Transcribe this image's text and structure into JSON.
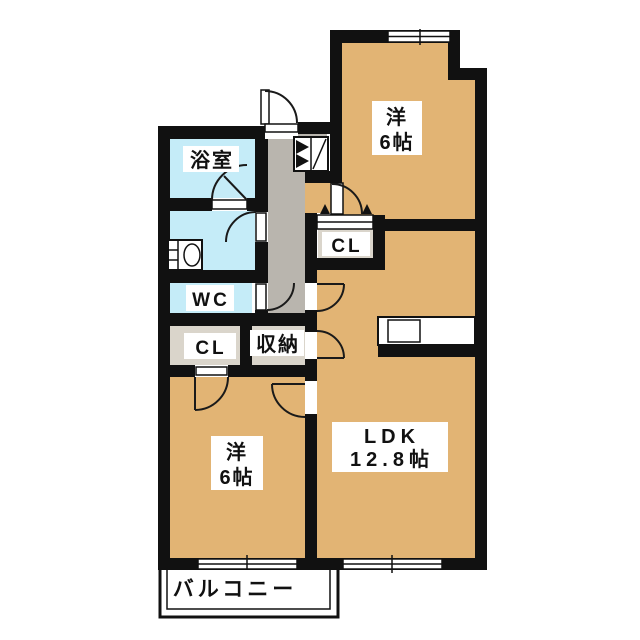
{
  "floorplan": {
    "labels": {
      "bathroom": "浴室",
      "toilet": "WC",
      "hall_closet": "CL",
      "storage": "収納",
      "bedroom_top_closet": "CL",
      "bedroom_top_name": "洋",
      "bedroom_top_size": "6帖",
      "bedroom_bottom_name": "洋",
      "bedroom_bottom_size": "6帖",
      "ldk_name": "LDK",
      "ldk_size": "12.8帖",
      "balcony": "バルコニー"
    },
    "colors": {
      "room": "#e2b474",
      "wet_area": "#c5ecf8",
      "hallway": "#b9b5ae",
      "closet": "#dad5cb",
      "wall": "#111111",
      "background": "#ffffff"
    }
  }
}
